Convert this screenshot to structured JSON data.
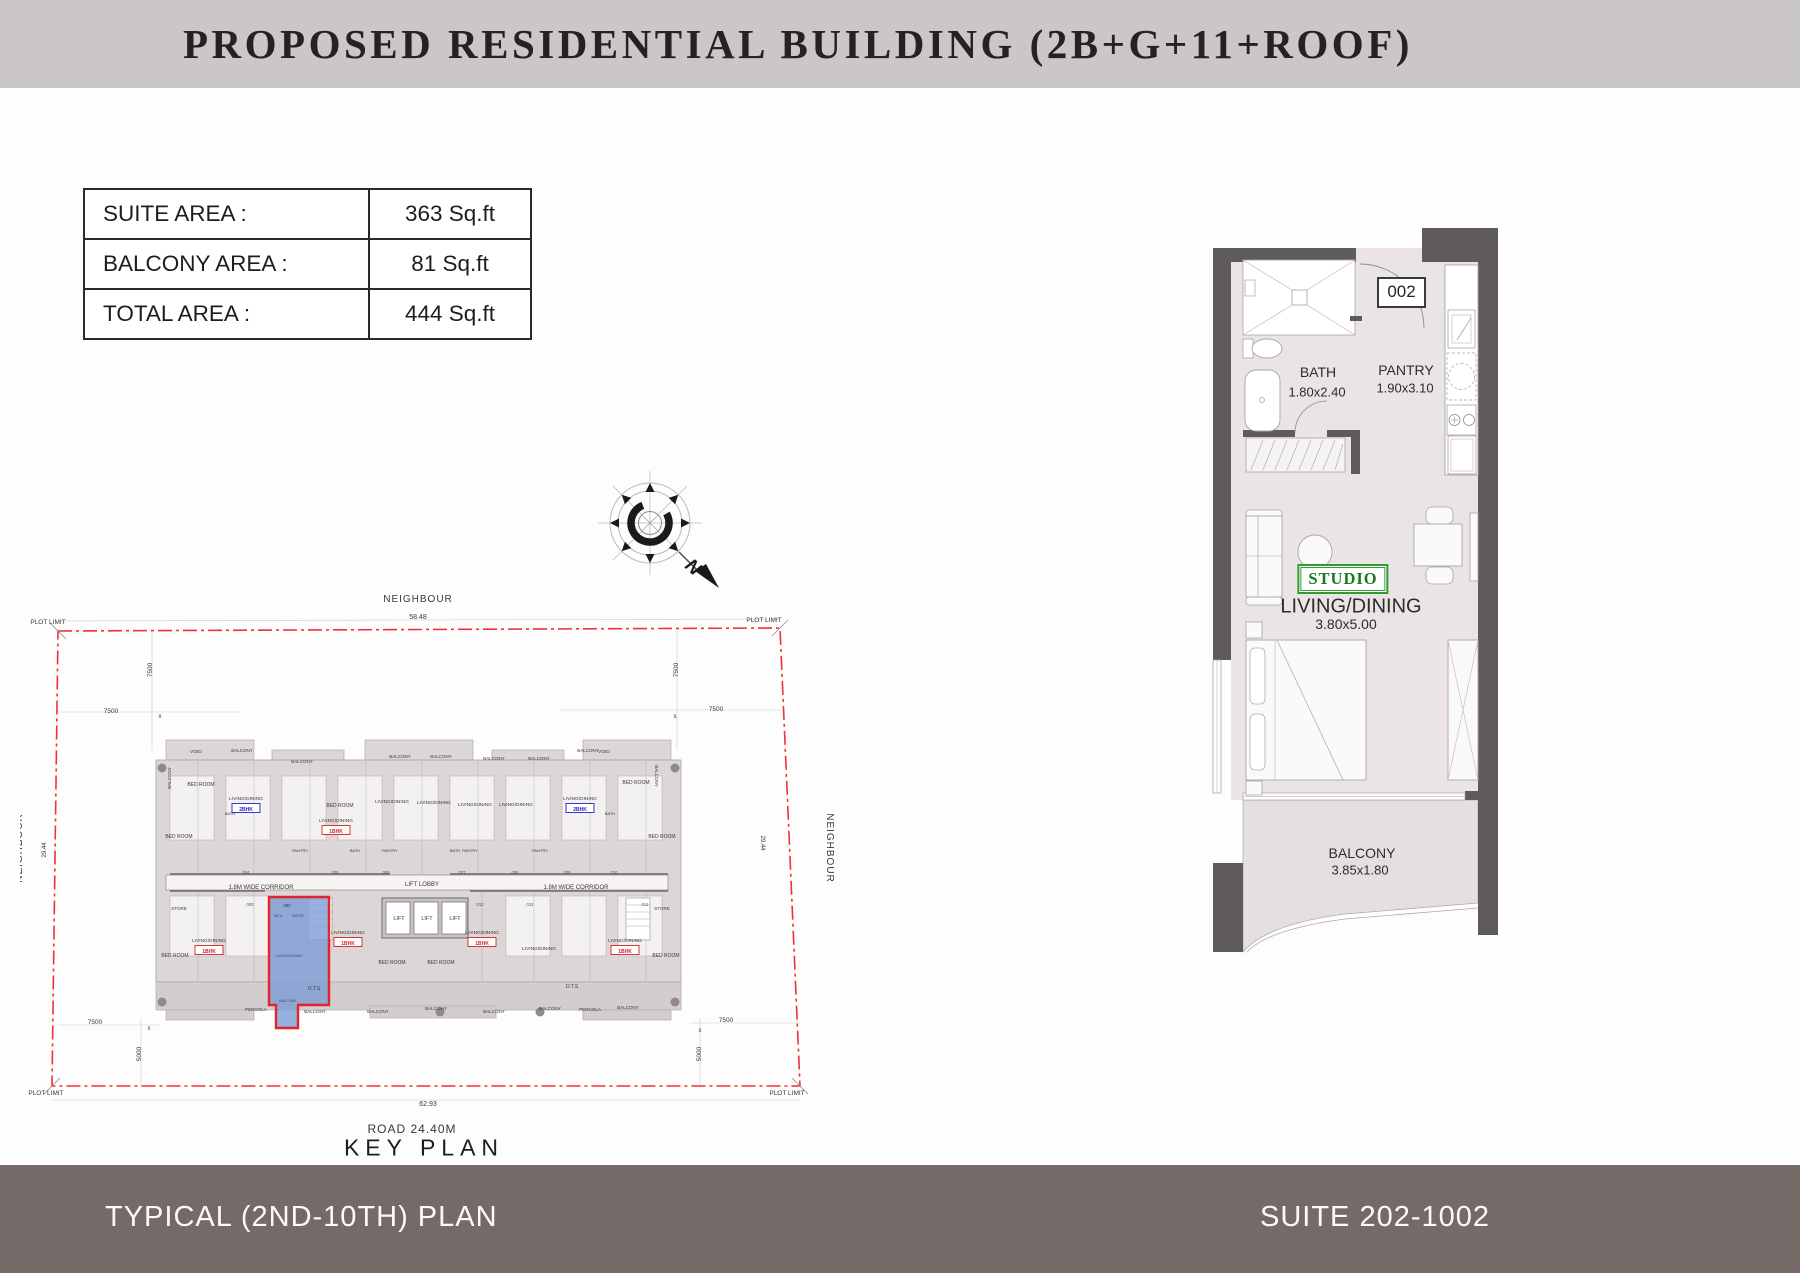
{
  "header": {
    "title": "PROPOSED RESIDENTIAL BUILDING (2B+G+11+ROOF)",
    "bg": "#cac7c6"
  },
  "area_table": {
    "rows": [
      {
        "label": "SUITE AREA :",
        "value": "363 Sq.ft"
      },
      {
        "label": "BALCONY AREA :",
        "value": "81 Sq.ft"
      },
      {
        "label": "TOTAL AREA :",
        "value": "444 Sq.ft"
      }
    ]
  },
  "compass": {
    "north_label": "N"
  },
  "unit_plan": {
    "entry_number": "002",
    "bath": {
      "name": "BATH",
      "dims": "1.80x2.40"
    },
    "pantry": {
      "name": "PANTRY",
      "dims": "1.90x3.10"
    },
    "type_badge": "STUDIO",
    "living": {
      "name": "LIVING/DINING",
      "dims": "3.80x5.00"
    },
    "balcony": {
      "name": "BALCONY",
      "dims": "3.85x1.80"
    }
  },
  "key_plan": {
    "title": "KEY PLAN",
    "road_label": "ROAD 24.40M",
    "highlight_color": "#7e9cd6",
    "highlight_outline": "#e4232b",
    "boundary_color": "#ee3237",
    "labels": [
      {
        "t": "NEIGHBOUR",
        "x": 418,
        "y": 602,
        "s": 10,
        "ls": 1
      },
      {
        "t": "NEIGHBOUR",
        "x": 22,
        "y": 848,
        "s": 10,
        "r": -90,
        "ls": 1
      },
      {
        "t": "NEIGHBOUR",
        "x": 827,
        "y": 848,
        "s": 10,
        "r": 90,
        "ls": 1
      },
      {
        "t": "58.48",
        "x": 418,
        "y": 619,
        "s": 7
      },
      {
        "t": "62.93",
        "x": 428,
        "y": 1106,
        "s": 7
      },
      {
        "t": "PLOT LIMIT",
        "x": 48,
        "y": 624,
        "s": 6.5
      },
      {
        "t": "PLOT LIMIT",
        "x": 764,
        "y": 622,
        "s": 6.5
      },
      {
        "t": "PLOT LIMIT",
        "x": 46,
        "y": 1095,
        "s": 6.5
      },
      {
        "t": "PLOT LIMIT",
        "x": 787,
        "y": 1095,
        "s": 6.5
      },
      {
        "t": "7500",
        "x": 111,
        "y": 713,
        "s": 6.5
      },
      {
        "t": "7500",
        "x": 716,
        "y": 711,
        "s": 6.5
      },
      {
        "t": "7500",
        "x": 152,
        "y": 670,
        "s": 6.5,
        "r": -90
      },
      {
        "t": "7500",
        "x": 678,
        "y": 670,
        "s": 6.5,
        "r": -90
      },
      {
        "t": "7500",
        "x": 95,
        "y": 1024,
        "s": 6.5
      },
      {
        "t": "7500",
        "x": 726,
        "y": 1022,
        "s": 6.5
      },
      {
        "t": "5000",
        "x": 141,
        "y": 1054,
        "s": 6.5,
        "r": -90
      },
      {
        "t": "5000",
        "x": 701,
        "y": 1054,
        "s": 6.5,
        "r": -90
      },
      {
        "t": "29.44",
        "x": 46,
        "y": 850,
        "s": 6,
        "r": -90
      },
      {
        "t": "29.44",
        "x": 761,
        "y": 843,
        "s": 6,
        "r": 90
      },
      {
        "t": "x",
        "x": 160,
        "y": 718,
        "s": 6
      },
      {
        "t": "x",
        "x": 675,
        "y": 718,
        "s": 6
      },
      {
        "t": "x",
        "x": 149,
        "y": 1030,
        "s": 6
      },
      {
        "t": "x",
        "x": 700,
        "y": 1032,
        "s": 6
      },
      {
        "t": "1.8M WIDE CORRIDOR",
        "x": 261,
        "y": 889,
        "s": 6
      },
      {
        "t": "1.8M WIDE CORRIDOR",
        "x": 576,
        "y": 889,
        "s": 6
      },
      {
        "t": "LIFT LOBBY",
        "x": 422,
        "y": 886,
        "s": 6
      },
      {
        "t": "LIFT",
        "x": 399,
        "y": 920,
        "s": 5.5
      },
      {
        "t": "LIFT",
        "x": 427,
        "y": 920,
        "s": 5.5
      },
      {
        "t": "LIFT",
        "x": 455,
        "y": 920,
        "s": 5.5
      },
      {
        "t": "VOID",
        "x": 196,
        "y": 753,
        "s": 4.8
      },
      {
        "t": "VOID",
        "x": 604,
        "y": 753,
        "s": 4.8
      },
      {
        "t": "BED ROOM",
        "x": 201,
        "y": 786,
        "s": 5
      },
      {
        "t": "BED ROOM",
        "x": 636,
        "y": 784,
        "s": 5
      },
      {
        "t": "BED ROOM",
        "x": 179,
        "y": 838,
        "s": 5
      },
      {
        "t": "BED ROOM",
        "x": 662,
        "y": 838,
        "s": 5
      },
      {
        "t": "BED ROOM",
        "x": 340,
        "y": 807,
        "s": 5
      },
      {
        "t": "BED ROOM",
        "x": 392,
        "y": 964,
        "s": 5
      },
      {
        "t": "BED ROOM",
        "x": 441,
        "y": 964,
        "s": 5
      },
      {
        "t": "BED ROOM",
        "x": 175,
        "y": 957,
        "s": 5
      },
      {
        "t": "BED ROOM",
        "x": 666,
        "y": 957,
        "s": 5
      },
      {
        "t": "BALCONY",
        "x": 242,
        "y": 752,
        "s": 4.5
      },
      {
        "t": "BALCONY",
        "x": 302,
        "y": 763,
        "s": 4.5
      },
      {
        "t": "BALCONY",
        "x": 400,
        "y": 758,
        "s": 4.5
      },
      {
        "t": "BALCONY",
        "x": 441,
        "y": 758,
        "s": 4.5
      },
      {
        "t": "BALCONY",
        "x": 494,
        "y": 760,
        "s": 4.5
      },
      {
        "t": "BALCONY",
        "x": 539,
        "y": 760,
        "s": 4.5
      },
      {
        "t": "BALCONY",
        "x": 588,
        "y": 752,
        "s": 4.5
      },
      {
        "t": "BALCONY",
        "x": 171,
        "y": 778,
        "s": 4.5,
        "r": -90
      },
      {
        "t": "BALCONY",
        "x": 655,
        "y": 776,
        "s": 4.5,
        "r": 90
      },
      {
        "t": "BALCONY",
        "x": 315,
        "y": 1013,
        "s": 4.5
      },
      {
        "t": "BALCONY",
        "x": 378,
        "y": 1013,
        "s": 4.5
      },
      {
        "t": "BALCONY",
        "x": 436,
        "y": 1010,
        "s": 4.5
      },
      {
        "t": "BALCONY",
        "x": 494,
        "y": 1013,
        "s": 4.5
      },
      {
        "t": "BALCONY",
        "x": 550,
        "y": 1010,
        "s": 4.5
      },
      {
        "t": "BALCONY",
        "x": 628,
        "y": 1009,
        "s": 4.5
      },
      {
        "t": "PERGOLA",
        "x": 256,
        "y": 1011,
        "s": 4.5
      },
      {
        "t": "PERGOLA",
        "x": 590,
        "y": 1011,
        "s": 4.5
      },
      {
        "t": "STORE",
        "x": 179,
        "y": 910,
        "s": 4.5
      },
      {
        "t": "STORE",
        "x": 662,
        "y": 910,
        "s": 4.5
      },
      {
        "t": "O.T.S",
        "x": 314,
        "y": 990,
        "s": 5
      },
      {
        "t": "O.T.S",
        "x": 572,
        "y": 988,
        "s": 5
      },
      {
        "t": "PANTRY",
        "x": 300,
        "y": 852,
        "s": 4
      },
      {
        "t": "PANTRY",
        "x": 390,
        "y": 852,
        "s": 4
      },
      {
        "t": "PANTRY",
        "x": 470,
        "y": 852,
        "s": 4
      },
      {
        "t": "PANTRY",
        "x": 540,
        "y": 852,
        "s": 4
      },
      {
        "t": "BATH",
        "x": 230,
        "y": 815,
        "s": 4
      },
      {
        "t": "BATH",
        "x": 610,
        "y": 815,
        "s": 4
      },
      {
        "t": "BATH",
        "x": 355,
        "y": 852,
        "s": 4
      },
      {
        "t": "BATH",
        "x": 455,
        "y": 852,
        "s": 4
      },
      {
        "t": "LIVING/DINING",
        "x": 392,
        "y": 803,
        "s": 4.8
      },
      {
        "t": "LIVING/DINING",
        "x": 434,
        "y": 804,
        "s": 4.8
      },
      {
        "t": "LIVING/DINING",
        "x": 475,
        "y": 806,
        "s": 4.8
      },
      {
        "t": "LIVING/DINING",
        "x": 516,
        "y": 806,
        "s": 4.8
      },
      {
        "t": "LIVING/DINING",
        "x": 336,
        "y": 822,
        "s": 4.8
      },
      {
        "t": "LIVING/DINING",
        "x": 246,
        "y": 800,
        "s": 4.8
      },
      {
        "t": "LIVING/DINING",
        "x": 580,
        "y": 800,
        "s": 4.8
      },
      {
        "t": "LIVING/DINING",
        "x": 209,
        "y": 942,
        "s": 4.8
      },
      {
        "t": "LIVING/DINING",
        "x": 348,
        "y": 934,
        "s": 4.8
      },
      {
        "t": "LIVING/DINING",
        "x": 482,
        "y": 934,
        "s": 4.8
      },
      {
        "t": "LIVING/DINING",
        "x": 539,
        "y": 950,
        "s": 4.8
      },
      {
        "t": "LIVING/DINING",
        "x": 625,
        "y": 942,
        "s": 4.8
      },
      {
        "t": "002",
        "x": 287,
        "y": 907,
        "s": 4.2,
        "c": "#333333"
      },
      {
        "t": "BATH",
        "x": 278,
        "y": 917,
        "s": 3.2,
        "c": "#3b4a66"
      },
      {
        "t": "PANTRY",
        "x": 298,
        "y": 917,
        "s": 3.2,
        "c": "#3b4a66"
      },
      {
        "t": "LIVING/DINING",
        "x": 289,
        "y": 957,
        "s": 3.8,
        "c": "#3b4a66"
      },
      {
        "t": "BALCONY",
        "x": 288,
        "y": 1002,
        "s": 3.6,
        "c": "#3b4a66"
      }
    ],
    "unit_numbers": [
      {
        "t": "004",
        "x": 246,
        "y": 874
      },
      {
        "t": "005",
        "x": 335,
        "y": 874
      },
      {
        "t": "006",
        "x": 386,
        "y": 874
      },
      {
        "t": "007",
        "x": 462,
        "y": 874
      },
      {
        "t": "008",
        "x": 515,
        "y": 874
      },
      {
        "t": "009",
        "x": 567,
        "y": 874
      },
      {
        "t": "010",
        "x": 614,
        "y": 874
      },
      {
        "t": "003",
        "x": 250,
        "y": 906
      },
      {
        "t": "013",
        "x": 480,
        "y": 906
      },
      {
        "t": "012",
        "x": 530,
        "y": 906
      },
      {
        "t": "011",
        "x": 645,
        "y": 906
      }
    ],
    "badges": [
      {
        "t": "2BHK",
        "x": 246,
        "y": 809,
        "c": "#2222cc"
      },
      {
        "t": "2BHK",
        "x": 580,
        "y": 809,
        "c": "#2222cc"
      },
      {
        "t": "1BHK",
        "x": 336,
        "y": 831,
        "c": "#d42222"
      },
      {
        "t": "1BHK",
        "x": 209,
        "y": 951,
        "c": "#d42222"
      },
      {
        "t": "1BHK",
        "x": 348,
        "y": 943,
        "c": "#d42222"
      },
      {
        "t": "1BHK",
        "x": 482,
        "y": 943,
        "c": "#d42222"
      },
      {
        "t": "1BHK",
        "x": 625,
        "y": 951,
        "c": "#d42222"
      }
    ]
  },
  "footer": {
    "left": "TYPICAL (2ND-10TH) PLAN",
    "right": "SUITE 202-1002",
    "bg": "#766a68"
  }
}
